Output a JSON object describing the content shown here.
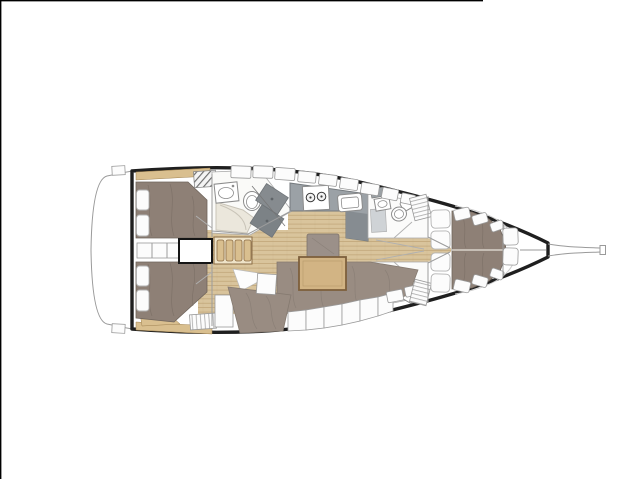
{
  "meta": {
    "title": "Sailing yacht interior layout plan (3 cabins / 3 heads, bow to the right)",
    "canvas": {
      "width": 640,
      "height": 479
    }
  },
  "plan": {
    "type": "yacht-floor-plan",
    "orientation": "bow-right",
    "features": [
      {
        "id": "transom",
        "name": "stern-transom-swim-platform"
      },
      {
        "id": "aft-cabin-port",
        "name": "aft-double-cabin-port"
      },
      {
        "id": "aft-cabin-starboard",
        "name": "aft-double-cabin-starboard"
      },
      {
        "id": "companionway",
        "name": "companionway-steps-and-engine-box"
      },
      {
        "id": "aft-head",
        "name": "aft-head-with-shower"
      },
      {
        "id": "galley",
        "name": "galley-stove-and-sink"
      },
      {
        "id": "salon",
        "name": "salon-settee-and-table"
      },
      {
        "id": "head-port",
        "name": "forward-head-port"
      },
      {
        "id": "head-starboard",
        "name": "forward-head-starboard"
      },
      {
        "id": "forward-cabin",
        "name": "forward-v-berth-cabin"
      },
      {
        "id": "anchor-locker",
        "name": "bow-anchor-locker"
      },
      {
        "id": "bowsprit",
        "name": "bowsprit"
      }
    ]
  },
  "colors": {
    "page_bg": "#ffffff",
    "frame": "#000000",
    "hull": "#1f1f1f",
    "outline": "#9a9a9a",
    "wood": "#d9c49c",
    "wood_line": "#bca173",
    "trim": "#d9bf8f",
    "trim_light": "#efe3c8",
    "trim_dark": "#8a6b45",
    "table": "#d2b484",
    "table_edge": "#7d5f3c",
    "berth": "#8e8076",
    "berth_edge": "#6f645b",
    "settee": "#998c82",
    "ottoman": "#9b9089",
    "counter": "#9ba1a6",
    "counter_dark": "#868c91",
    "shower": "#868b8f",
    "shower_dark": "#7c8286",
    "cream": "#ebe7dc",
    "gray_tile": "#cfd3d6",
    "white": "#fcfcfc"
  }
}
